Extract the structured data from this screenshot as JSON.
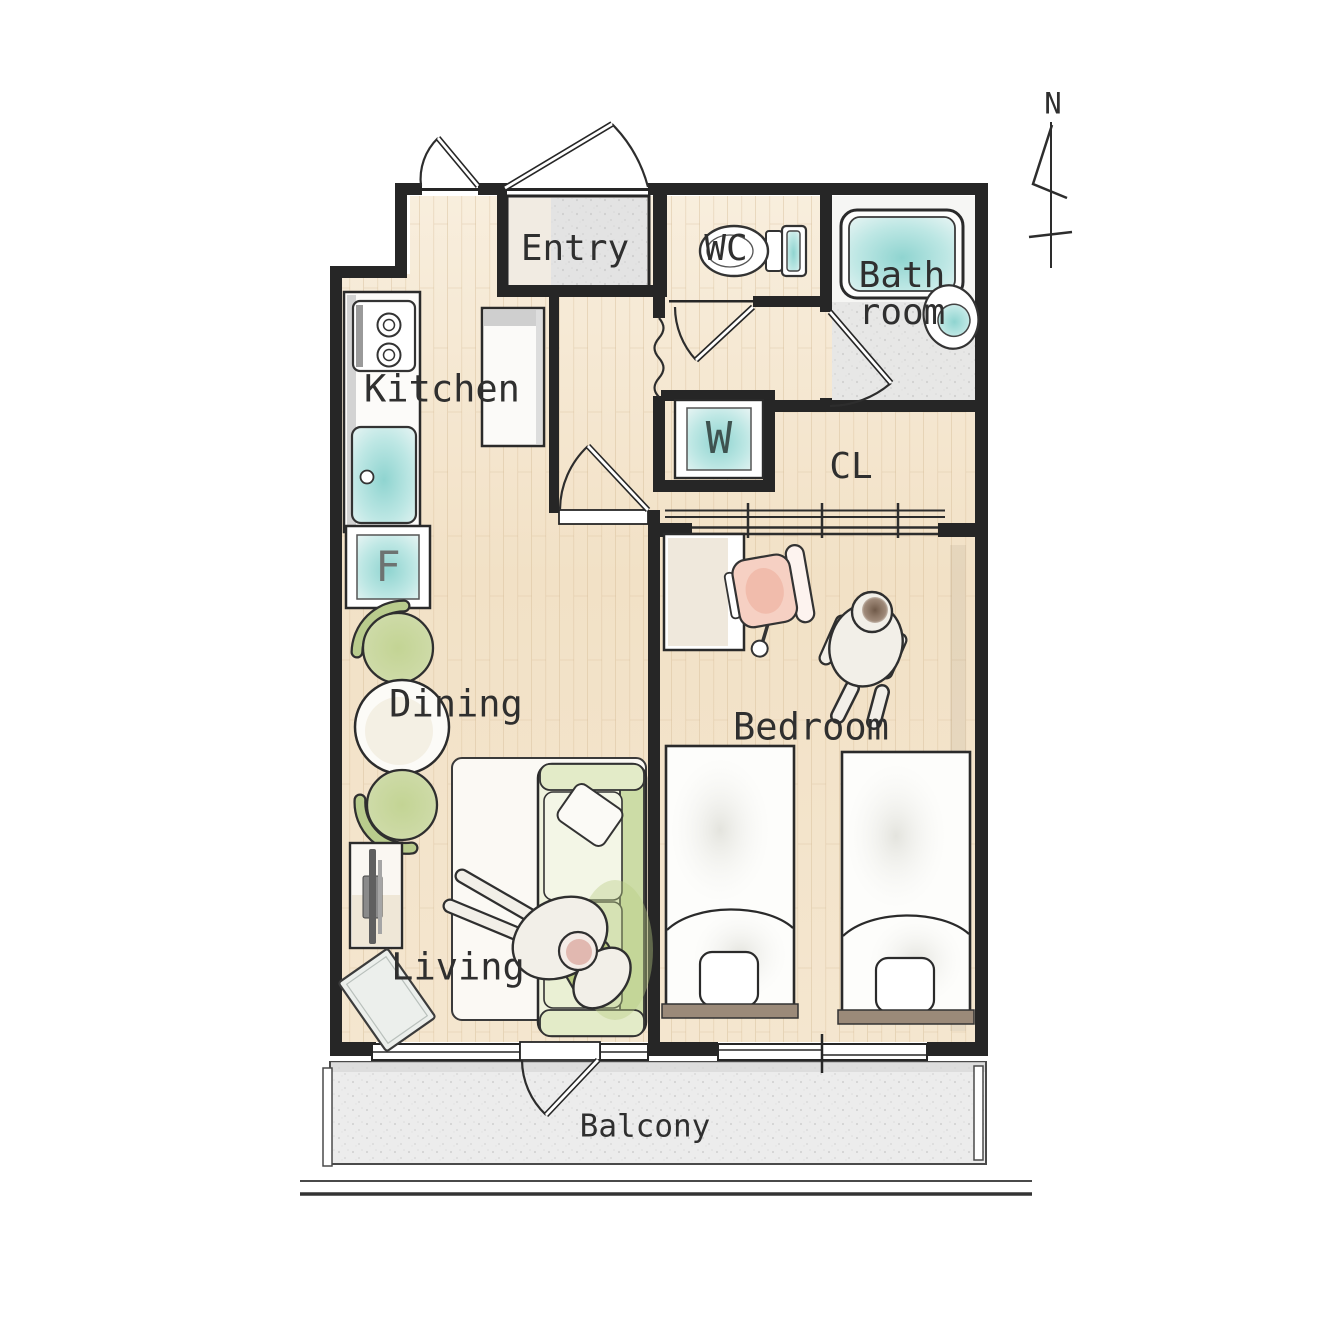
{
  "plan": {
    "compass": {
      "label": "N"
    },
    "rooms": {
      "entry": {
        "label": "Entry"
      },
      "wc": {
        "label": "WC"
      },
      "bathroom": {
        "label_line1": "Bath",
        "label_line2": "room"
      },
      "kitchen": {
        "label": "Kitchen"
      },
      "closet": {
        "label": "CL"
      },
      "dining": {
        "label": "Dining"
      },
      "living": {
        "label": "Living"
      },
      "bedroom": {
        "label": "Bedroom"
      },
      "balcony": {
        "label": "Balcony"
      }
    },
    "appliances": {
      "fridge": {
        "label": "F"
      },
      "washer": {
        "label": "W"
      }
    },
    "colors": {
      "wall": "#262626",
      "outline": "#2d2d2d",
      "wood": "#f3e5cc",
      "wood_line": "#d6bd99",
      "teal": "#8fd4d0",
      "green": "#c3d494",
      "pink": "#f6d0c3",
      "gray_floor": "#e9e9e9",
      "headboard": "#9b8a79",
      "label_text": "#2f2f2f"
    }
  }
}
